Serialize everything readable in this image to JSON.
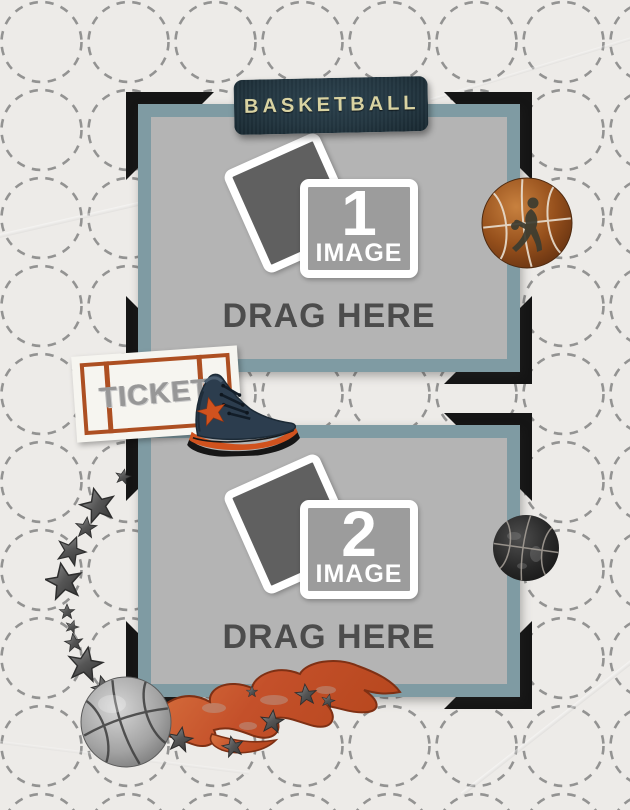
{
  "page": {
    "type": "scrapbook-photo-collage-template",
    "theme": "basketball"
  },
  "banner": {
    "title": "BASKETBALL",
    "icons": [
      "corner-flag-icon",
      "basketball-icon"
    ]
  },
  "frames": [
    {
      "id": "frame-1",
      "number": "1",
      "image_label": "IMAGE",
      "drag_label": "DRAG HERE"
    },
    {
      "id": "frame-2",
      "number": "2",
      "image_label": "IMAGE",
      "drag_label": "DRAG HERE"
    }
  ],
  "ticket": {
    "label": "TICKET"
  },
  "decorations": [
    "basketball-player-ball-sticker",
    "dark-basketball-sticker",
    "sneaker-sticker",
    "ticket-stub-sticker",
    "star-trail-sticker",
    "flaming-basketball-sticker"
  ],
  "colors": {
    "paper": "#edebe8",
    "dashed_circle": "#7d7d7d",
    "frame_mat_teal": "#7f9ba3",
    "corner_bracket_black": "#151515",
    "placeholder_gray": "#b4b4b4",
    "photo_front_fill": "#9c9c9c",
    "photo_back_fill": "#606060",
    "drag_text": "#4c4c4c",
    "banner_bg": "#22343e",
    "banner_text": "#d9d3a2",
    "accent_orange": "#cc5424",
    "ticket_border": "#ad4f22",
    "ticket_text": "#979797",
    "shoe_navy": "#2c3d4e",
    "star_metal": "#5b5b5b",
    "ball_orange": "#96501c",
    "ball_dark": "#262626",
    "ball_gray": "#a8a8a8",
    "flame_orange": "#c75a2e"
  }
}
